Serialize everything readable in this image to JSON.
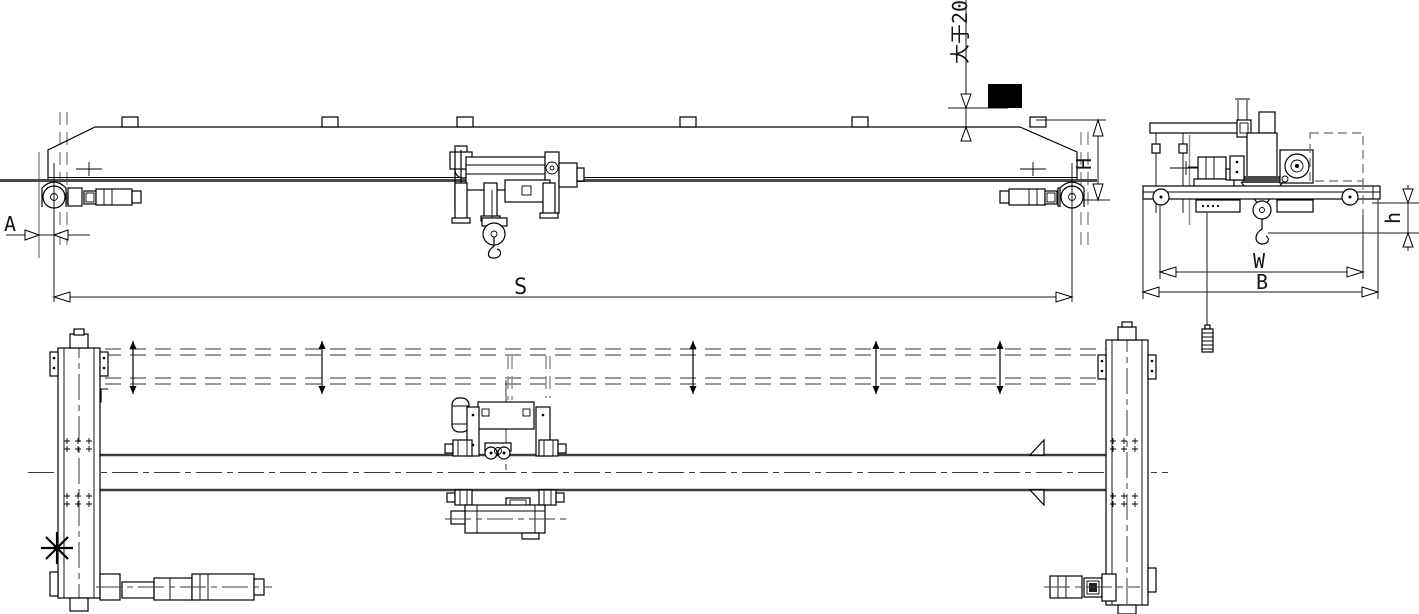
{
  "drawing_labels": {
    "clearance_note": "大于200",
    "span": "S",
    "approach": "A",
    "height": "H",
    "hook_height": "h",
    "trolley_gauge": "W",
    "end_carriage_width": "B"
  },
  "colors": {
    "primary_line": "#000000",
    "secondary_line": "#8a8a8a",
    "thick_flange": "#4a4a4a",
    "buffer_fill": "#000000",
    "background": "#ffffff"
  }
}
